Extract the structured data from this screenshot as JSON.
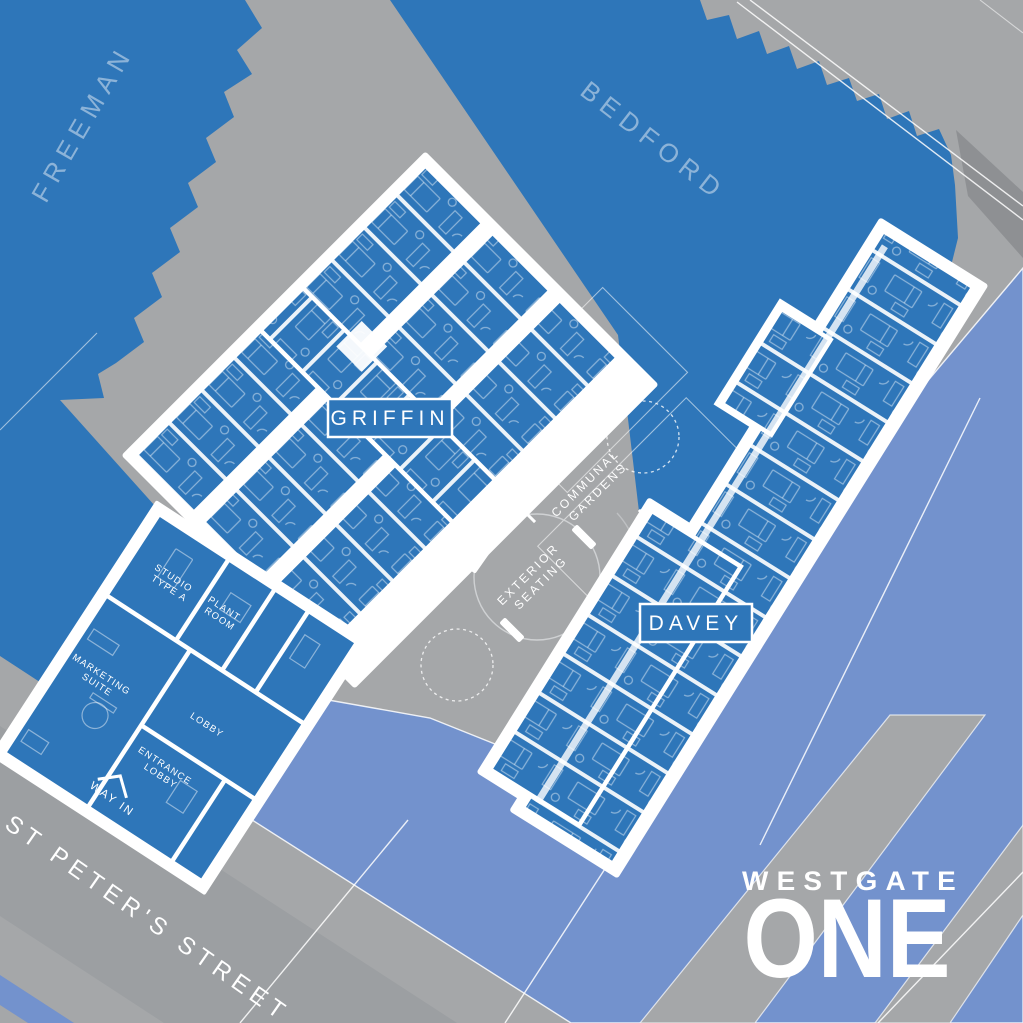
{
  "parcels": {
    "freeman": "FREEMAN",
    "bedford": "BEDFORD"
  },
  "buildings": {
    "griffin": "GRIFFIN",
    "davey": "DAVEY"
  },
  "rooms": {
    "studio_1": "STUDIO",
    "studio_2": "TYPE A",
    "plant_1": "PLANT",
    "plant_2": "ROOM",
    "marketing_1": "MARKETING",
    "marketing_2": "SUITE",
    "lobby": "LOBBY",
    "entrance_1": "ENTRANCE",
    "entrance_2": "LOBBY"
  },
  "streets": {
    "st_peters": "ST PETER'S STREET",
    "way_in": "WAY IN"
  },
  "landscape": {
    "communal_1": "COMMUNAL",
    "communal_2": "GARDENS",
    "seating_1": "EXTERIOR",
    "seating_2": "SEATING"
  },
  "logo": {
    "line1": "WESTGATE",
    "line2": "ONE"
  },
  "colors": {
    "building_blue": "#2e76b9",
    "periwinkle": "#7392cd",
    "road_gray": "#a5a7a9",
    "street_gray": "#9c9fa2",
    "dark_gray": "#8e9093",
    "white": "#ffffff"
  }
}
